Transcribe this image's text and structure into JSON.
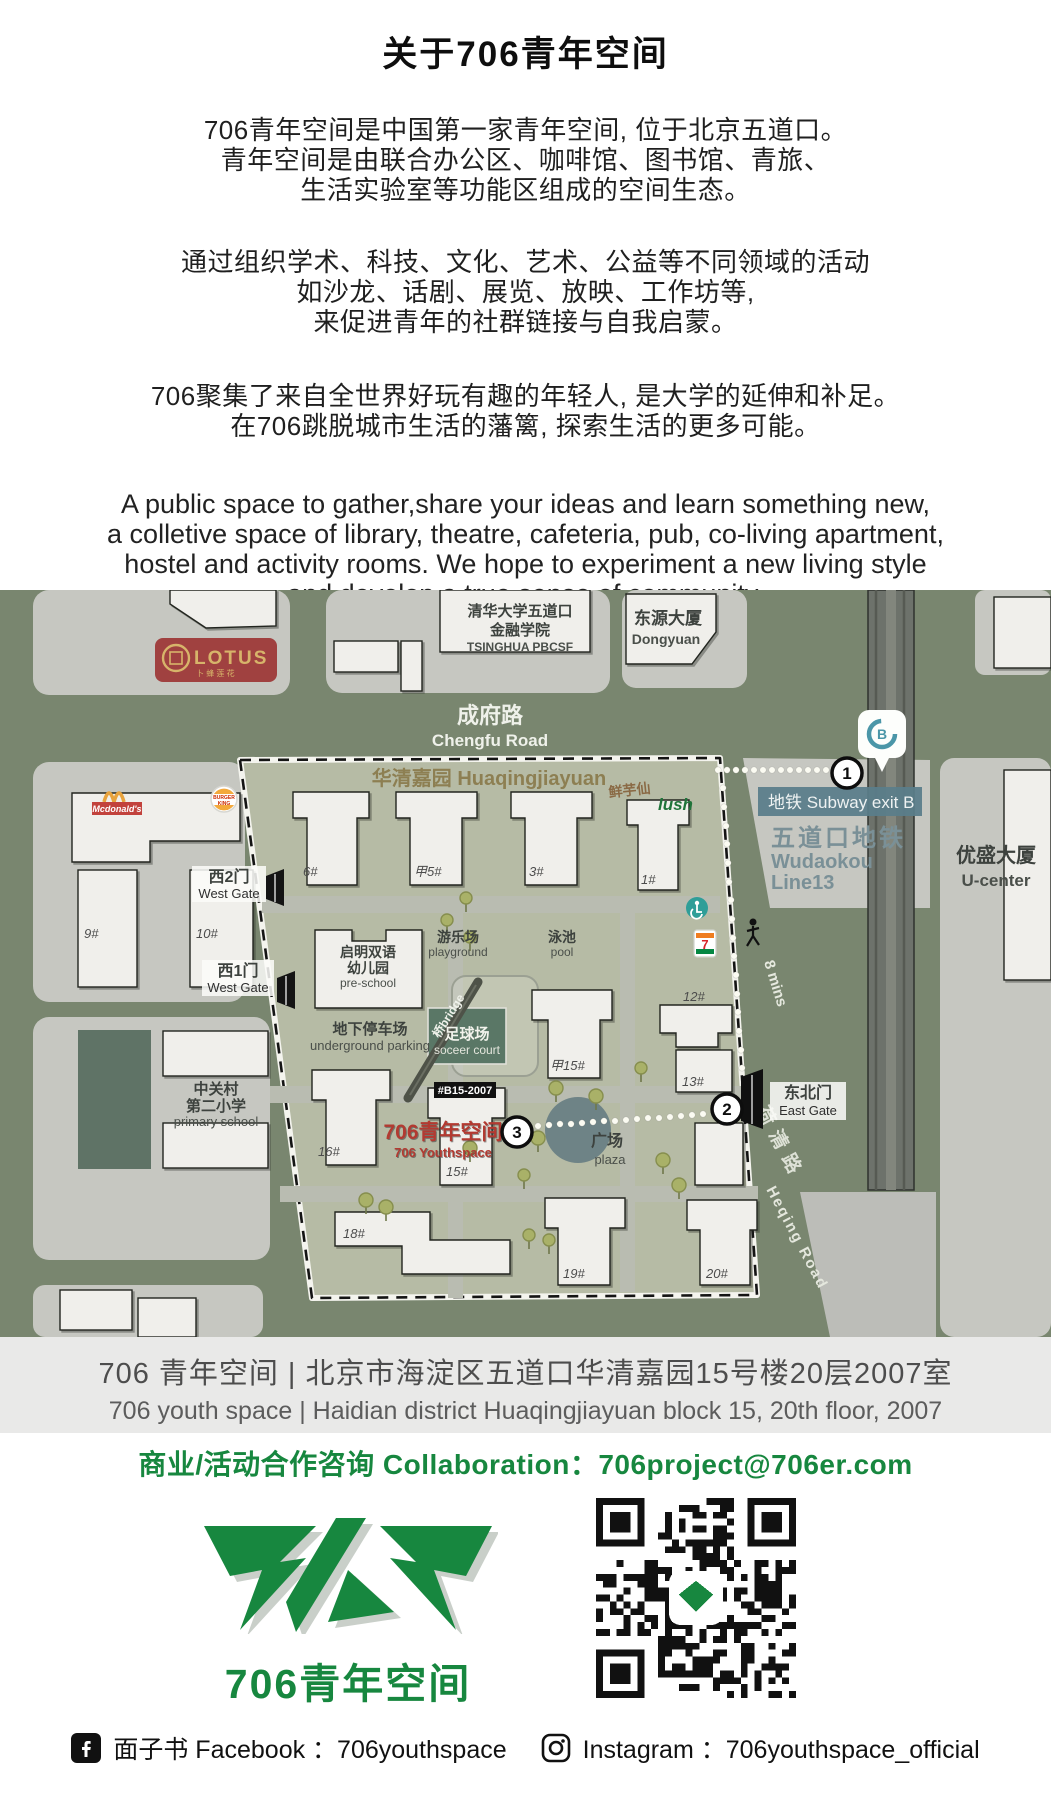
{
  "about": {
    "title": "关于706青年空间",
    "p1": [
      "706青年空间是中国第一家青年空间, 位于北京五道口。",
      "青年空间是由联合办公区、咖啡馆、图书馆、青旅、",
      "生活实验室等功能区组成的空间生态。"
    ],
    "p2": [
      "通过组织学术、科技、文化、艺术、公益等不同领域的活动",
      "如沙龙、话剧、展览、放映、工作坊等,",
      "来促进青年的社群链接与自我启蒙。"
    ],
    "p3": [
      "706聚集了来自全世界好玩有趣的年轻人, 是大学的延伸和补足。",
      "在706跳脱城市生活的藩篱, 探索生活的更多可能。"
    ],
    "en": [
      "A public space to gather,share your ideas and learn something new,",
      "a colletive space of library, theatre, cafeteria, pub, co-living apartment,",
      "hostel and activity rooms. We hope to experiment a new living style",
      "and develop a true sense of community."
    ]
  },
  "map": {
    "roads": {
      "chengfu_zh": "成府路",
      "chengfu_en": "Chengfu Road",
      "heqing_zh": "荷清路",
      "heqing_en": "Heqing Road"
    },
    "complex": {
      "name": "华清嘉园 Huaqingjiayuan"
    },
    "subway": {
      "exit_label": "地铁 Subway exit B",
      "station_zh": "五道口地铁",
      "station_en": "Wudaokou",
      "line": "Line13",
      "marker": "1",
      "pin_letter": "B"
    },
    "gates": {
      "west2_zh": "西2门",
      "west1_zh": "西1门",
      "west_en": "West Gate",
      "east_zh": "东北门",
      "east_en": "East Gate",
      "east_marker": "2"
    },
    "walk_time": "8 mins",
    "pois": {
      "lotus": "LOTUS",
      "lotus_sub": "卜 蜂 莲 花",
      "mcdonalds": "Mcdonald's",
      "bk1": "BURGER",
      "bk2": "KING",
      "seven": "7",
      "xianyuxian": "鲜芋仙",
      "lush": "lush",
      "tsinghua": [
        "清华大学五道口",
        "金融学院",
        "TSINGHUA PBCSF"
      ],
      "dongyuan_zh": "东源大厦",
      "dongyuan_en": "Dongyuan",
      "ucenter_zh": "优盛大厦",
      "ucenter_en": "U-center",
      "school": [
        "中关村",
        "第二小学",
        "primary school"
      ],
      "preschool": [
        "启明双语",
        "幼儿园",
        "pre-school"
      ],
      "playground_zh": "游乐场",
      "playground_en": "playground",
      "pool_zh": "泳池",
      "pool_en": "pool",
      "parking_zh": "地下停车场",
      "parking_en": "underground parking",
      "soccer_zh": "足球场",
      "soccer_en": "soceer court",
      "bridge": "桥bridge",
      "plaza_zh": "广场",
      "plaza_en": "plaza"
    },
    "destination": {
      "tag": "#B15-2007",
      "name_zh": "706青年空间",
      "name_en": "706 Youthspace",
      "marker": "3"
    },
    "buildings": {
      "b6": "6#",
      "b5a": "甲5#",
      "b3": "3#",
      "b1": "1#",
      "b9": "9#",
      "b10": "10#",
      "b12": "12#",
      "b13": "13#",
      "b15a": "甲15#",
      "b16": "16#",
      "b15": "15#",
      "b18": "18#",
      "b19": "19#",
      "b20": "20#"
    }
  },
  "address_bar": {
    "line_zh": "706 青年空间 | 北京市海淀区五道口华清嘉园15号楼20层2007室",
    "line_en": "706 youth space | Haidian district Huaqingjiayuan block 15, 20th floor, 2007"
  },
  "collaboration": {
    "text": "商业/活动合作咨询 Collaboration：706project@706er.com"
  },
  "branding": {
    "logo_caption": "706青年空间",
    "accent_green": "#17873f",
    "logo_red": "#b23a31"
  },
  "footer": {
    "facebook": "面子书 Facebook ：706youthspace",
    "instagram": "Instagram ：706youthspace_official"
  },
  "colors": {
    "map_road": "#79866f",
    "map_block": "#c6c7c1",
    "huaqing_block": "#b6bba5",
    "soccer_court": "#5a7766",
    "subway_label": "#5a7d8a",
    "lotus_red": "#a04140",
    "plaza": "#6e8386"
  }
}
